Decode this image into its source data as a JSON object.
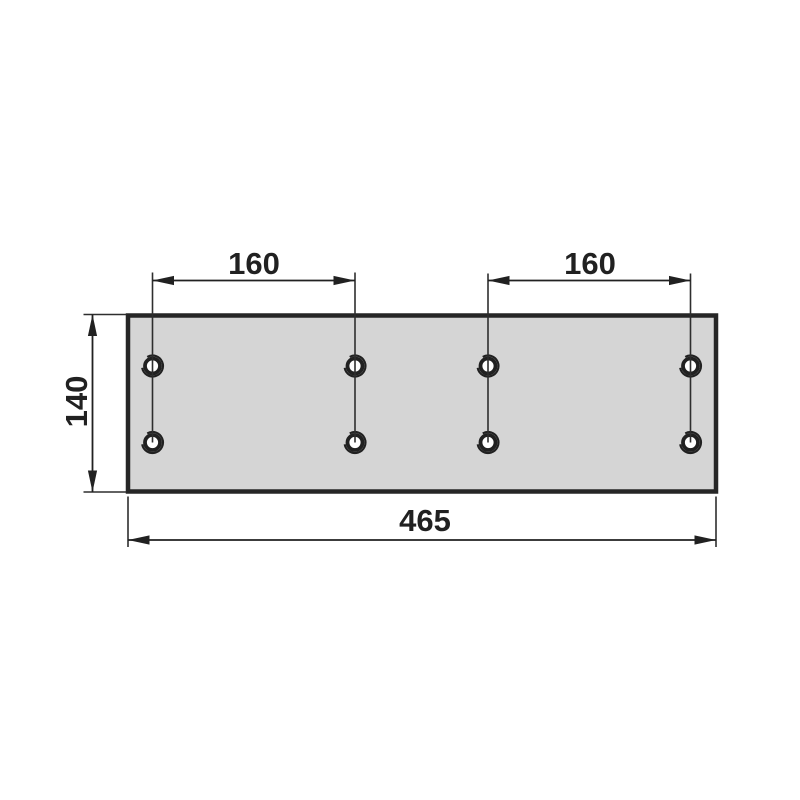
{
  "drawing": {
    "description": "technical dimension drawing of a rectangular mounting plate with two rows of four holes",
    "dimensions": {
      "top_left": {
        "value": "160",
        "orientation": "horizontal",
        "measures": "spacing between hole column 1 and hole column 2"
      },
      "top_right": {
        "value": "160",
        "orientation": "horizontal",
        "measures": "spacing between hole column 3 and hole column 4"
      },
      "left": {
        "value": "140",
        "orientation": "vertical",
        "measures": "plate height"
      },
      "bottom": {
        "value": "465",
        "orientation": "horizontal",
        "measures": "plate width"
      }
    },
    "part": {
      "shape": "rectangular plate",
      "hole_count": 8,
      "hole_rows": 2,
      "hole_columns": 4
    },
    "colors": {
      "background": "#ffffff",
      "plate_fill": "#d5d5d5",
      "line": "#212121",
      "text": "#212121"
    }
  }
}
